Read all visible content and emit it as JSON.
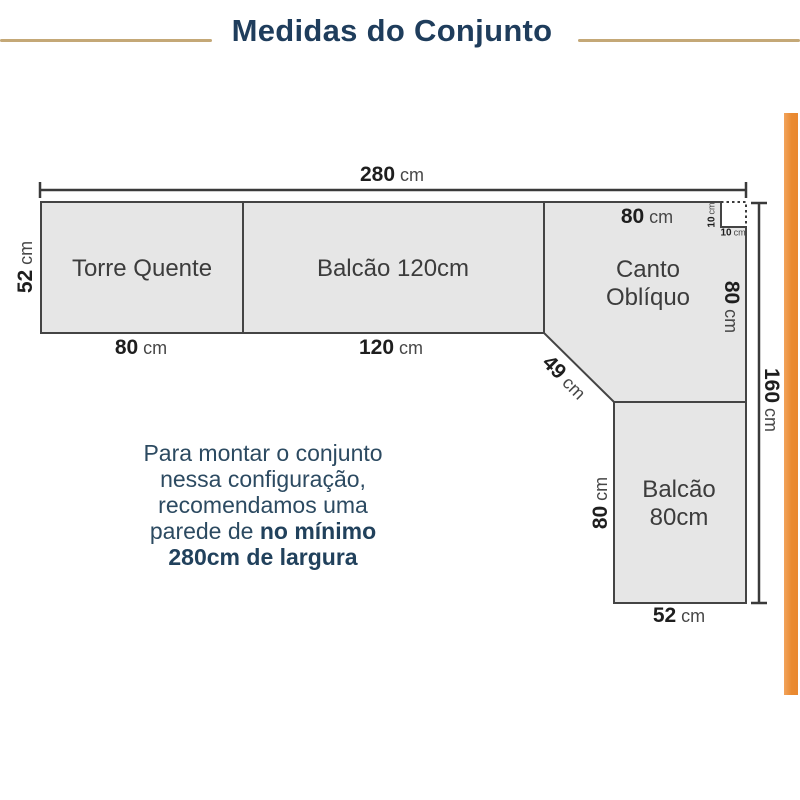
{
  "title": "Medidas do Conjunto",
  "colors": {
    "accent_orange": "#EA8A31",
    "rule_tan": "#C4A877",
    "title_navy": "#1F3D5C",
    "shape_fill": "#E6E6E6",
    "line_dark": "#3A3A3A"
  },
  "cabinets": {
    "torre_quente": {
      "label": "Torre Quente"
    },
    "balcao_120": {
      "label": "Balcão 120cm"
    },
    "canto_obliquo": {
      "line1": "Canto",
      "line2": "Oblíquo"
    },
    "balcao_80": {
      "line1": "Balcão",
      "line2": "80cm"
    }
  },
  "dimensions": {
    "total_width": {
      "value": "280",
      "unit": "cm"
    },
    "depth_left": {
      "value": "52",
      "unit": "cm"
    },
    "torre_width": {
      "value": "80",
      "unit": "cm"
    },
    "balcao120_width": {
      "value": "120",
      "unit": "cm"
    },
    "canto_top_width": {
      "value": "80",
      "unit": "cm"
    },
    "canto_right_depth": {
      "value": "80",
      "unit": "cm"
    },
    "notch_vertical": {
      "value": "10",
      "unit": "cm"
    },
    "notch_horizontal": {
      "value": "10",
      "unit": "cm"
    },
    "diagonal": {
      "value": "49",
      "unit": "cm"
    },
    "balcao80_height": {
      "value": "80",
      "unit": "cm"
    },
    "balcao80_width": {
      "value": "52",
      "unit": "cm"
    },
    "total_height": {
      "value": "160",
      "unit": "cm"
    }
  },
  "note": {
    "line1": "Para montar o conjunto",
    "line2": "nessa configuração,",
    "line3": "recomendamos uma",
    "line4_regular": "parede de ",
    "line4_bold": "no mínimo",
    "line5_bold": "280cm de largura"
  }
}
